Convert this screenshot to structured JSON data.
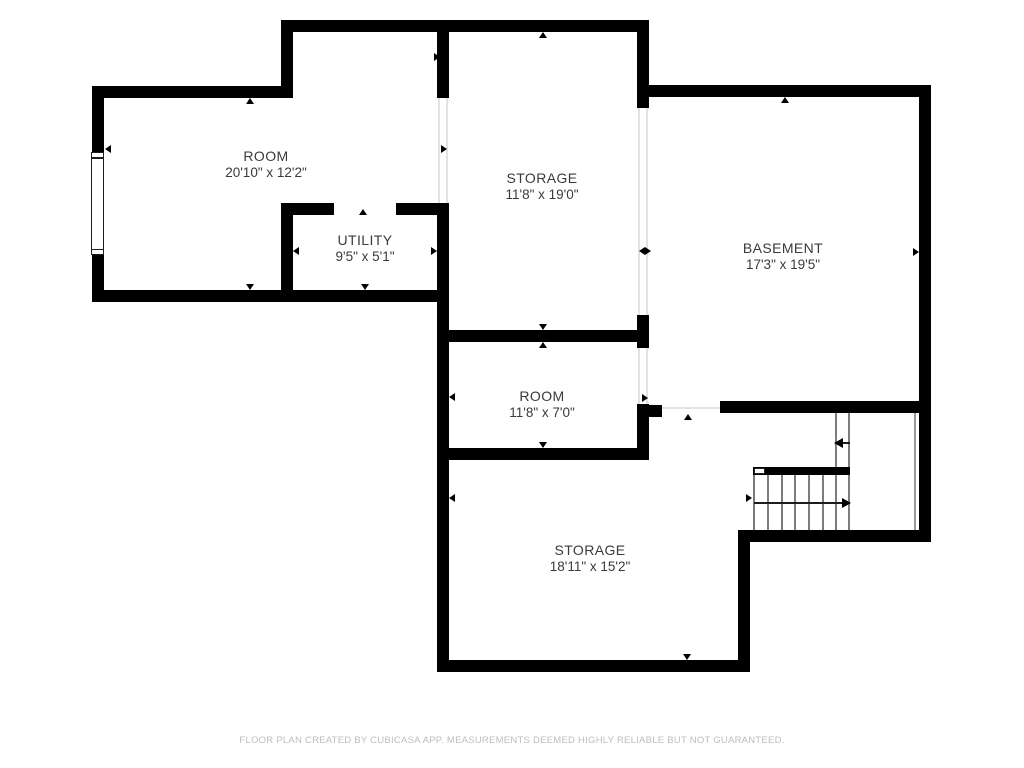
{
  "rooms": [
    {
      "name": "ROOM",
      "dimensions": "20'10\" x 12'2\""
    },
    {
      "name": "STORAGE",
      "dimensions": "11'8\" x 19'0\""
    },
    {
      "name": "BASEMENT",
      "dimensions": "17'3\" x 19'5\""
    },
    {
      "name": "UTILITY",
      "dimensions": "9'5\" x 5'1\""
    },
    {
      "name": "ROOM",
      "dimensions": "11'8\" x 7'0\""
    },
    {
      "name": "STORAGE",
      "dimensions": "18'11\" x 15'2\""
    }
  ],
  "footer": {
    "disclaimer": "FLOOR PLAN CREATED BY CUBICASA APP. MEASUREMENTS DEEMED HIGHLY RELIABLE BUT NOT GUARANTEED."
  },
  "colors": {
    "wall": "#000000",
    "room_text": "#3a3a3a",
    "footer_text": "#bdbdbd",
    "opening_line": "#e2e2e2",
    "stair_line": "#7c7c7c",
    "background": "#ffffff"
  }
}
